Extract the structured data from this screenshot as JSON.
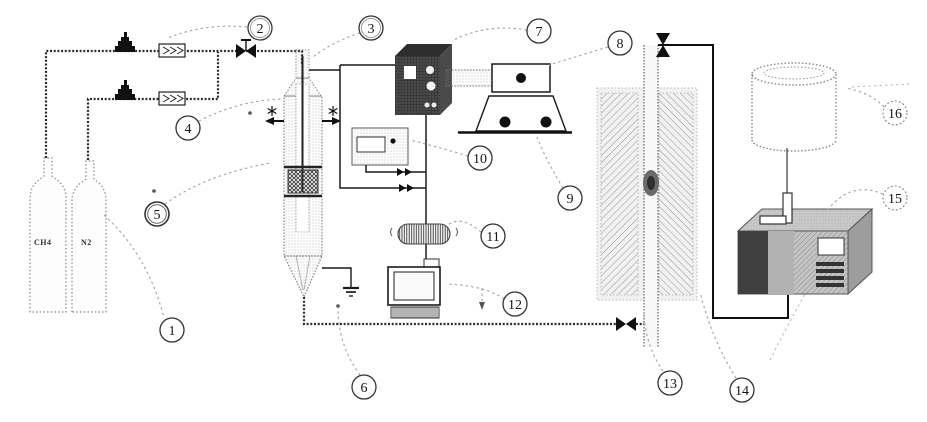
{
  "cylinders": [
    {
      "label": "CH4"
    },
    {
      "label": "N2"
    }
  ],
  "callouts": [
    {
      "label": "1"
    },
    {
      "label": "2"
    },
    {
      "label": "3"
    },
    {
      "label": "4"
    },
    {
      "label": "5"
    },
    {
      "label": "6"
    },
    {
      "label": "7"
    },
    {
      "label": "8"
    },
    {
      "label": "9"
    },
    {
      "label": "10"
    },
    {
      "label": "11"
    },
    {
      "label": "12"
    },
    {
      "label": "13"
    },
    {
      "label": "14"
    },
    {
      "label": "15"
    },
    {
      "label": "16"
    }
  ],
  "colors": {
    "ink": "#1a1a1a",
    "pipe_gray": "#8c8c8c",
    "leader_gray": "#aaaaaa",
    "background": "#ffffff"
  }
}
